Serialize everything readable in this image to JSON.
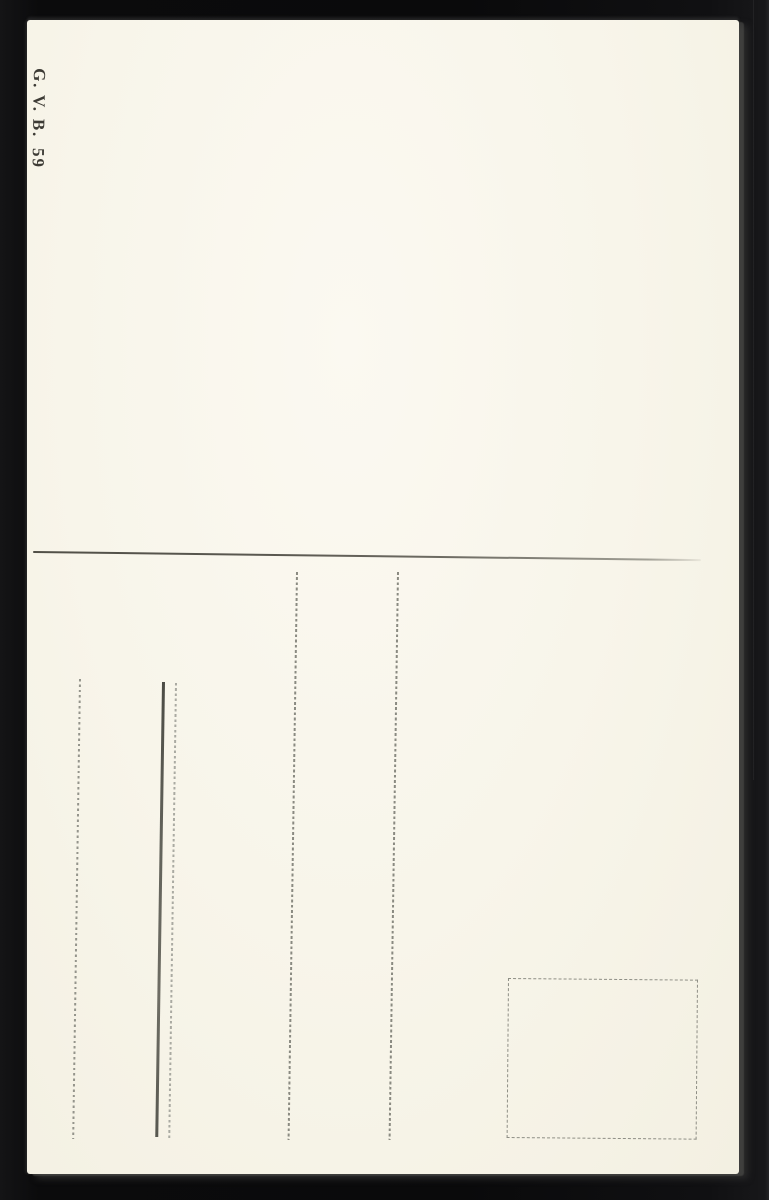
{
  "photo": {
    "backdrop_color": "#0b0b0c",
    "card_color": "#f8f5ea",
    "card_edge_highlight_color": "#565652"
  },
  "postcard": {
    "publisher_code": "G. V. B.",
    "card_number": "59",
    "divider_color": "#55534b",
    "dotted_line_color": "#8a8a81",
    "solid_line_color": "#5c5c54",
    "stamp_box_border_color": "#8e8e85"
  }
}
